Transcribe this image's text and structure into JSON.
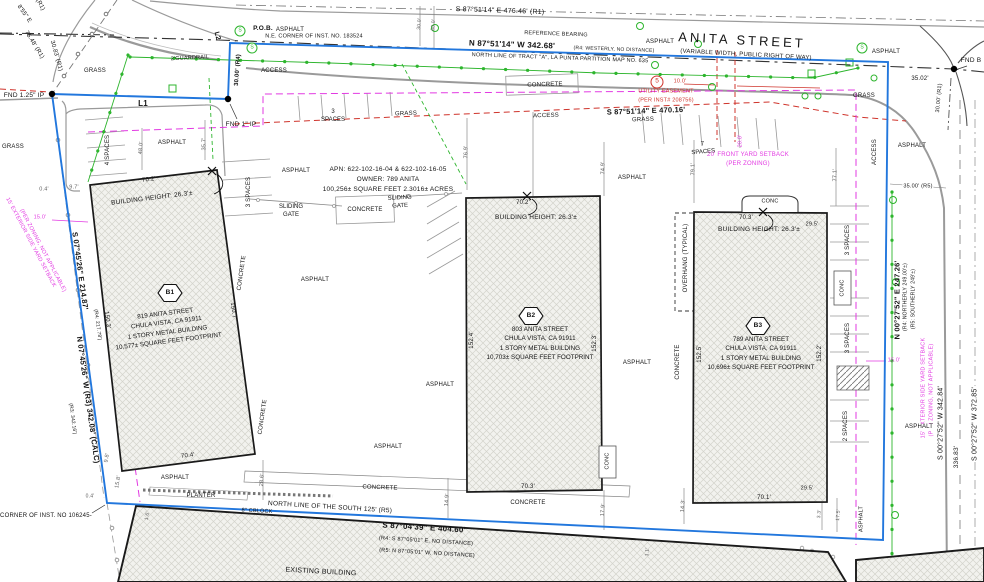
{
  "street": {
    "name": "ANITA STREET",
    "subtitle": "(VARIABLE WIDTH, PUBLIC RIGHT OF WAY)",
    "north_bearing": "S 87°51'14\" E  476.46' (R1)",
    "reference_bearing_label": "REFERENCE BEARING",
    "main_bearing": "N 87°51'14\" W  342.68'",
    "main_bearing_note": "(R4: WESTERLY, NO DISTANCE)",
    "north_line_note": "NORTH LINE OF TRACT \"A\", LA PUNTA PARTITION MAP NO. 635",
    "south_bearing": "S 87°51'14\" E  470.16'",
    "guardrail": "2'GUARDRAIL"
  },
  "monuments": {
    "pob": "P.O.B.",
    "pob_note": "N.E. CORNER OF INST. NO. 183524",
    "fnd_125": "FND 1.25\" IP",
    "fnd_1": "FND 1\" IP",
    "fnd_b": "FND B",
    "corner_inst": "CORNER OF INST. NO 106245-",
    "l1": "L1",
    "l2": "L2",
    "sewer": "S"
  },
  "west": {
    "bearing1": "S 07°45'26\" E  214.87'",
    "bearing1_note": "(R4: 217.78')",
    "bearing2": "N 07°45'26\" W (R3) 342.08' (CALC)",
    "bearing2_note": "(R3: 342.16')",
    "diag0": "(R1)",
    "diag1": "8'55\" E",
    "diag2": "75.48' (R1)",
    "diag3": "30.83' (R1)"
  },
  "east": {
    "bearing1": "N 00°27'52\" E  247.26'",
    "bearing1_note1": "(R4: NORTHERLY 249.00'±)",
    "bearing1_note2": "(R5: SOUTHERLY 249'±)",
    "bearing2": "S 00°27'52\" W  342.84'",
    "d336": "336.83'",
    "bearing3": "S 00°27'52\" W  372.85'"
  },
  "south": {
    "north_line": "NORTH LINE OF THE SOUTH 125' (R5)",
    "bearing": "S 87°04'39\" E  404.60'",
    "note1": "(R4: S 87°05'01\" E, NO DISTANCE)",
    "note2": "(R5: N 87°05'01\" W, NO DISTANCE)"
  },
  "parcel": {
    "apn": "APN: 622-102-16-04 & 622-102-16-05",
    "owner": "OWNER: 789 ANITA",
    "area": "100,256± SQUARE FEET 2.3016± ACRES"
  },
  "buildings": {
    "b1": {
      "id": "B1",
      "lines": [
        "819 ANITA STREET",
        "CHULA VISTA, CA 91911",
        "1 STORY METAL BUILDING",
        "10,577± SQUARE FEET FOOTPRINT"
      ],
      "height": "BUILDING HEIGHT: 26.3'±",
      "top": "70.2'",
      "bottom": "70.4'",
      "left": "150.3'",
      "right": "150.7'"
    },
    "b2": {
      "id": "B2",
      "lines": [
        "803 ANITA STREET",
        "CHULA VISTA, CA 91911",
        "1 STORY METAL BUILDING",
        "10,703± SQUARE FEET FOOTPRINT"
      ],
      "height": "BUILDING HEIGHT: 26.3'±",
      "top": "70.2'",
      "bottom": "70.3'",
      "left": "152.4'",
      "right": "152.3'"
    },
    "b3": {
      "id": "B3",
      "lines": [
        "789 ANITA STREET",
        "CHULA VISTA, CA 91911",
        "1 STORY METAL BUILDING",
        "10,696± SQUARE FEET FOOTPRINT"
      ],
      "height": "BUILDING HEIGHT: 26.3'±",
      "top": "70.3'",
      "bottom": "70.1'",
      "left": "152.5'",
      "right": "152.2'"
    },
    "existing": "EXISTING BUILDING"
  },
  "setbacks": {
    "front": "20' FRONT YARD SETBACK",
    "front_note": "(PER ZONING)",
    "front_dim": "20.0'",
    "side": "15' EXTERIOR SIDE YARD SETBACK",
    "side_note": "(PER ZONING, NOT APPLICABLE)",
    "side_dim": "15.0'"
  },
  "easement": {
    "num": "5",
    "width": "10.0'",
    "name": "UTILITY EASEMENT",
    "note": "(PER INST# 208756)"
  },
  "surfaces": {
    "asphalt": "ASPHALT",
    "grass": "GRASS",
    "concrete": "CONCRETE",
    "conc": "CONC",
    "access": "ACCESS",
    "planter": "PLANTER",
    "cblock": "8\" CBLOCK",
    "overhang": "OVERHANG (TYPICAL)"
  },
  "parking": {
    "n3": "3",
    "n7": "7",
    "word": "SPACES",
    "p4": "4 SPACES",
    "p3": "3 SPACES",
    "p2": "2 SPACES"
  },
  "gate": {
    "l1": "SLIDING",
    "l2": "GATE"
  },
  "dims": {
    "d35_02": "35.02'",
    "d30_00_r1": "30.00' (R1)",
    "d35_00_r5": "35.00' (R5)",
    "d30_00_r4": "30.00' (R4)",
    "d30_0": "30.0'",
    "d60_0": "60.0'",
    "d76_9": "76.9'",
    "d74_9": "74.9'",
    "d79_1": "79.1'",
    "d77_1": "77.1'",
    "d35_7": "35.7'",
    "d48_0": "48.0'",
    "d9_7": "9.7'",
    "d0_4": "0.4'",
    "d9_8": "9.8'",
    "d15_8": "15.8'",
    "d1_6": "1.6'",
    "d28_6": "28.6'",
    "d14_9": "14.9'",
    "d17_9": "17.9'",
    "d14_3": "14.3'",
    "d3_3": "3.3'",
    "d17_5": "17.5'",
    "d1_1": "1.1'",
    "d29_5": "29.5'"
  },
  "colors": {
    "boundary": "#2277dd",
    "fence": "#2db52d",
    "easement": "#cf342c",
    "setback": "#e23ae2",
    "road": "#9a9a9a"
  }
}
